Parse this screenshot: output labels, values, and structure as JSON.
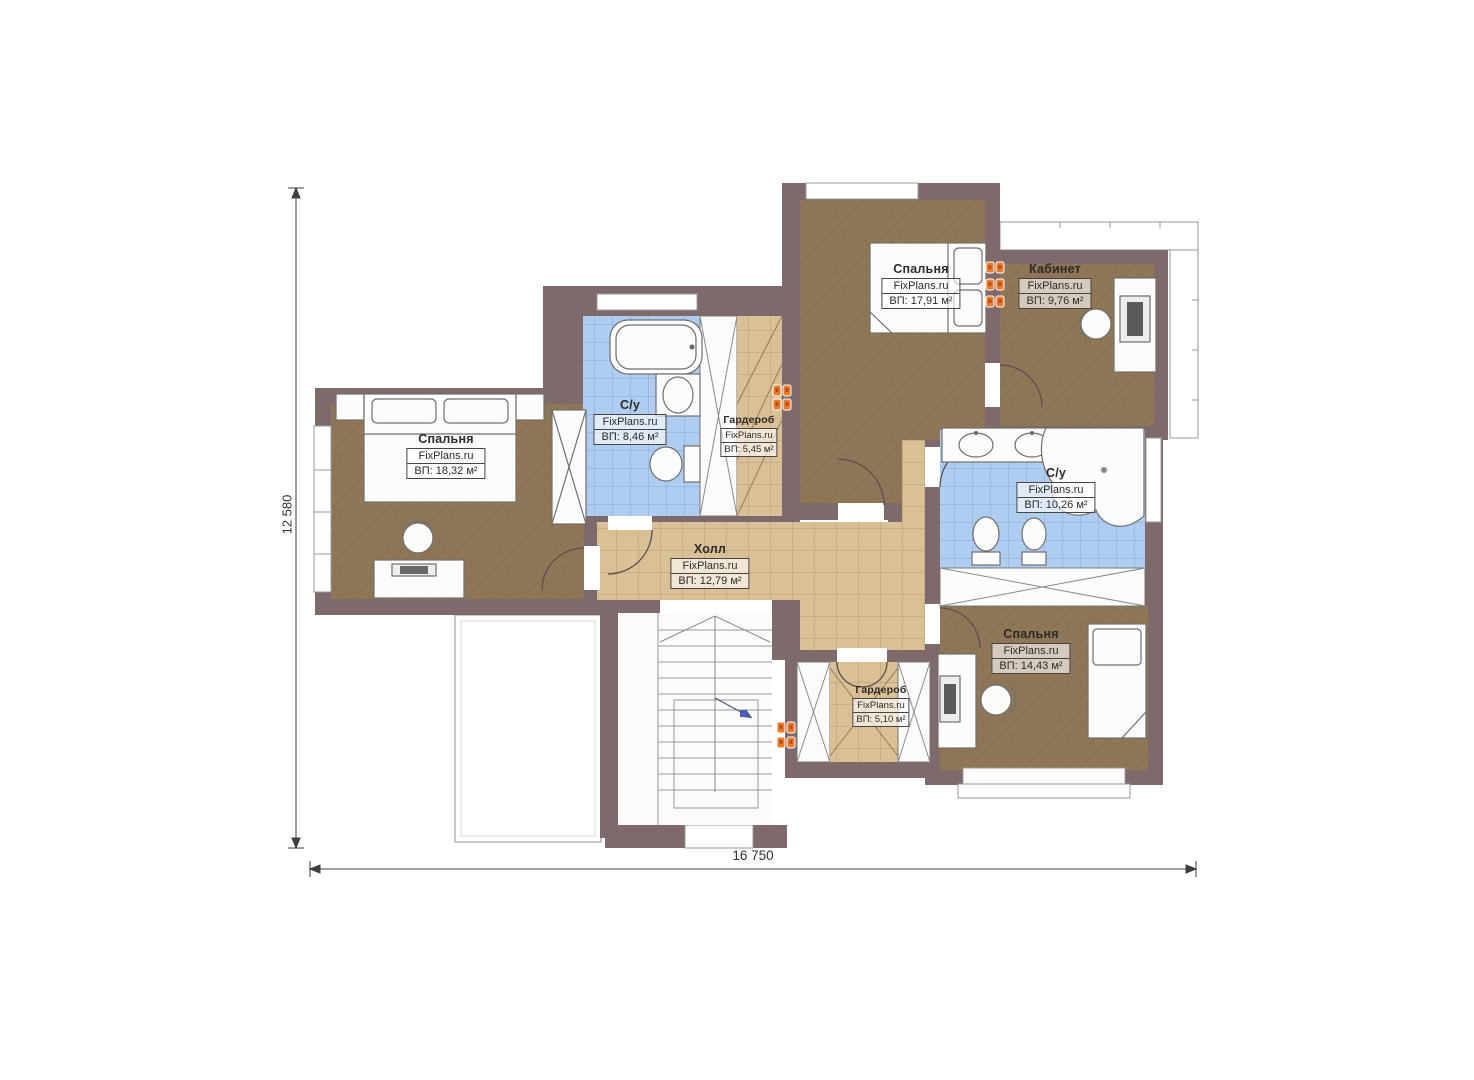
{
  "plan": {
    "dimensions": {
      "height_label": "12 580",
      "width_label": "16 750"
    },
    "rooms": [
      {
        "id": "bedroom-left",
        "name": "Спальня",
        "watermark": "FixPlans.ru",
        "area": "ВП: 18,32 м²"
      },
      {
        "id": "bathroom-top",
        "name": "С/у",
        "watermark": "FixPlans.ru",
        "area": "ВП: 8,46 м²"
      },
      {
        "id": "wardrobe-top",
        "name": "Гардероб",
        "watermark": "FixPlans.ru",
        "area": "ВП: 5,45 м²"
      },
      {
        "id": "bedroom-top",
        "name": "Спальня",
        "watermark": "FixPlans.ru",
        "area": "ВП: 17,91 м²"
      },
      {
        "id": "office",
        "name": "Кабинет",
        "watermark": "FixPlans.ru",
        "area": "ВП: 9,76 м²"
      },
      {
        "id": "bathroom-right",
        "name": "С/у",
        "watermark": "FixPlans.ru",
        "area": "ВП: 10,26 м²"
      },
      {
        "id": "hall",
        "name": "Холл",
        "watermark": "FixPlans.ru",
        "area": "ВП: 12,79 м²"
      },
      {
        "id": "bedroom-bottom",
        "name": "Спальня",
        "watermark": "FixPlans.ru",
        "area": "ВП: 14,43 м²"
      },
      {
        "id": "wardrobe-bottom",
        "name": "Гардероб",
        "watermark": "FixPlans.ru",
        "area": "ВП: 5,10 м²"
      }
    ],
    "colors": {
      "wall": "#7e6a6b",
      "floor_wood": "#8e7656",
      "tile_blue": "#aecdf0",
      "tile_tan": "#d9c096",
      "radiator_orange": "#ec7b28"
    }
  }
}
